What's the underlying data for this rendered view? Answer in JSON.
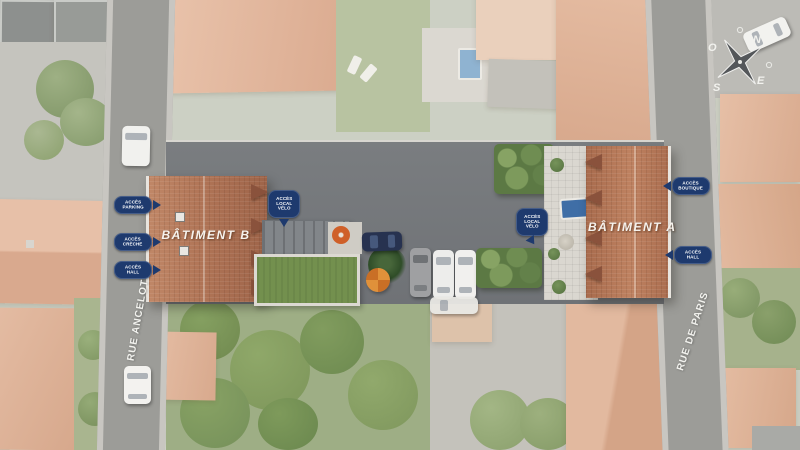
{
  "buildings": {
    "a": {
      "label": "BÂTIMENT A"
    },
    "b": {
      "label": "BÂTIMENT B"
    }
  },
  "streets": {
    "ancelot": "RUE ANCELOT",
    "paris": "RUE DE PARIS"
  },
  "access": {
    "parking": "ACCÈS PARKING",
    "creche": "ACCÈS CRÈCHE",
    "hall_b": "ACCÈS HALL",
    "velo_b": "ACCÈS LOCAL VÉLO",
    "velo_a": "ACCÈS LOCAL VÉLO",
    "boutique": "ACCÈS BOUTIQUE",
    "hall_a": "ACCÈS HALL"
  },
  "compass": {
    "north": "N",
    "south": "S",
    "east": "E",
    "west": "O"
  },
  "colors": {
    "access_label_bg": "#1e3a6e",
    "roof_terracotta": "#b0755a",
    "asphalt": "#75787b",
    "green_roof": "#73904e",
    "pool_blue": "#3f6ea6",
    "road_gray": "#9c9c98"
  }
}
